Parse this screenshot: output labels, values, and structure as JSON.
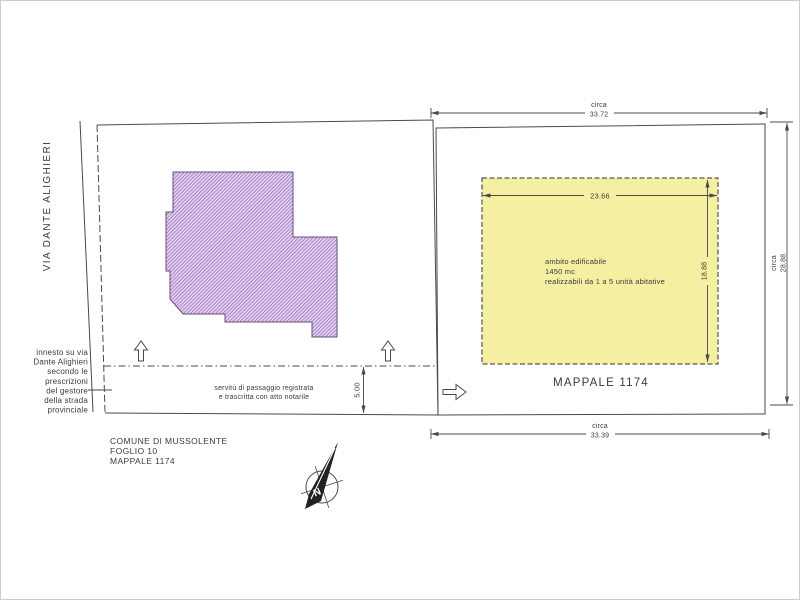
{
  "colors": {
    "page_border": "#cccccc",
    "line": "#4a4a4a",
    "text": "#3b3b3b",
    "building_fill": "#e6d6f0",
    "building_hatch": "#a77fc4",
    "building_stroke": "#6a4e7a",
    "buildable_fill": "#f5efa2",
    "compass_needle": "#222222"
  },
  "road": {
    "name": "VIA DANTE ALIGHIERI",
    "entry_note_lines": [
      "innesto su via",
      "Dante Alighieri",
      "secondo le",
      "prescrizioni",
      "del gestore",
      "della strada",
      "provinciale"
    ]
  },
  "left_parcel": {
    "easement_lines": [
      "servitù di passaggio registrata",
      "e trascritta con atto notarile"
    ],
    "easement_width": "5.00"
  },
  "right_parcel": {
    "label": "MAPPALE 1174",
    "buildable_area": {
      "lines": [
        "ambito edificabile",
        "1450 mc",
        "realizzabili da 1 a 5 unità abitative"
      ],
      "width": "23.66",
      "depth": "18.88"
    },
    "dimensions": {
      "approx_label": "circa",
      "top": "33.72",
      "bottom": "33.39",
      "right": "28.88"
    }
  },
  "title_block": {
    "lines": [
      "COMUNE DI MUSSOLENTE",
      "FOGLIO 10",
      "MAPPALE 1174"
    ]
  },
  "compass": {
    "north_label": "N"
  }
}
